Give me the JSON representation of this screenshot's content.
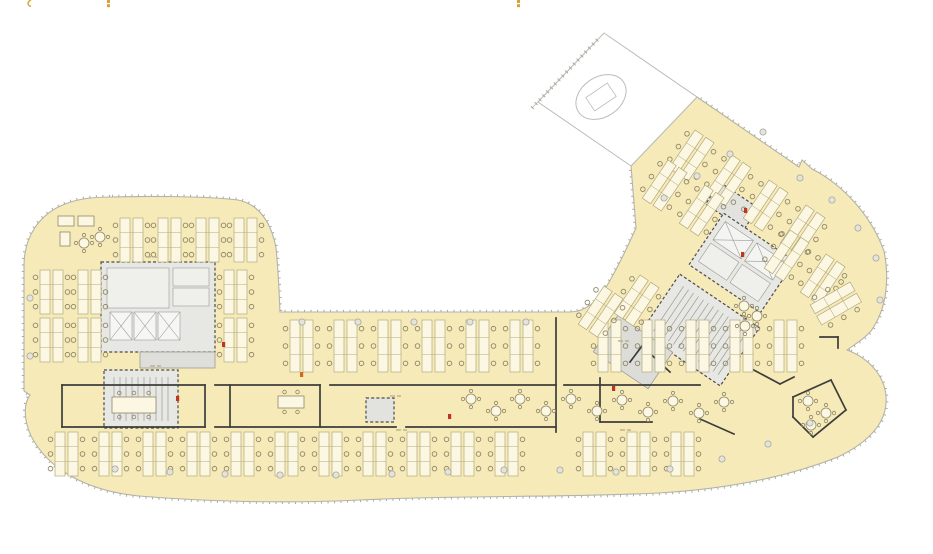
{
  "document": {
    "type": "architectural-floor-plan",
    "visible_text": "",
    "note_labels_illegible": true
  },
  "colors": {
    "background": "#ffffff",
    "floor": "#f6eab9",
    "outline": "#b3b3aa",
    "facade_tick": "#a9a9a0",
    "core_fill": "#e7e7e4",
    "core_inner": "#efefec",
    "core_line": "#9b9b95",
    "core_dash": "#4c4c48",
    "wall": "#3d3d3b",
    "desk_fill": "#fcf7e2",
    "desk_line": "#b4aa7c",
    "chair": "#8f8768",
    "column_fill": "#e4e4dc",
    "column_line": "#a8a89e",
    "atrium_line": "#bcbcb6",
    "micro_label": "#b5ab88",
    "accent_red": "#c3341f",
    "accent_orange": "#d2691e",
    "fragment_orange": "#d9a036"
  },
  "plan": {
    "outline_path": "M 112,197 C 150,196 205,196 238,200 C 258,204 271,221 276,248 C 278,266 279,288 280,312 L 570,312 C 586,312 598,301 608,284 C 620,263 628,246 636,228 L 631,166 L 697,97 L 799,167 L 802,160 L 812,169 C 842,184 871,215 884,251 C 890,281 886,310 871,331 C 862,341 852,346 847,350 C 866,357 884,373 886,396 C 888,421 871,441 838,457 C 787,477 729,489 659,493 C 559,498 459,495 359,500 C 279,504 199,501 139,496 C 89,491 49,471 31,436 C 23,418 24,403 30,395 L 24,391 L 24,266 C 24,237 39,214 65,204 C 80,198 96,197 112,197 Z",
    "atrium": {
      "points": "538,102 604,33 697,97 631,166",
      "tick_line": {
        "x1": 532,
        "y1": 108,
        "x2": 598,
        "y2": 39
      },
      "ellipse": {
        "cx": 601,
        "cy": 97,
        "rx": 27,
        "ry": 20,
        "rot": -34
      },
      "inner_rect": {
        "x": 588,
        "y": 89,
        "w": 26,
        "h": 16
      }
    },
    "cores": [
      {
        "name": "core-left-main",
        "x": 101,
        "y": 262,
        "w": 114,
        "h": 90,
        "dashed": true,
        "cells": [
          {
            "dx": 6,
            "dy": 6,
            "w": 62,
            "h": 40,
            "fill": "#efefec"
          },
          {
            "dx": 9,
            "dy": 50,
            "w": 22,
            "h": 28,
            "fill": "#f6f6f4",
            "cross": true
          },
          {
            "dx": 33,
            "dy": 50,
            "w": 22,
            "h": 28,
            "fill": "#f6f6f4",
            "cross": true
          },
          {
            "dx": 57,
            "dy": 50,
            "w": 22,
            "h": 28,
            "fill": "#f6f6f4",
            "cross": true
          },
          {
            "dx": 72,
            "dy": 6,
            "w": 36,
            "h": 18,
            "fill": "#efefec"
          },
          {
            "dx": 72,
            "dy": 26,
            "w": 36,
            "h": 18,
            "fill": "#efefec"
          }
        ]
      },
      {
        "name": "core-left-connector",
        "x": 140,
        "y": 352,
        "w": 75,
        "h": 16,
        "fill": "#dededb"
      },
      {
        "name": "core-left-stair",
        "x": 104,
        "y": 370,
        "w": 74,
        "h": 58,
        "dashed": true,
        "hatch": {
          "from": 10,
          "to": 64,
          "step": 6,
          "pad": 7
        }
      },
      {
        "name": "core-mid-small",
        "x": 366,
        "y": 398,
        "w": 28,
        "h": 24,
        "fill": "#e2e2df",
        "dashed": true
      },
      {
        "name": "core-wing-upper",
        "x": 709,
        "y": 193,
        "w": 46,
        "h": 26,
        "rot": 34,
        "fill": "#e2e2df",
        "dashed": true
      },
      {
        "name": "core-wing-elevator",
        "x": 699,
        "y": 232,
        "w": 86,
        "h": 62,
        "rot": 34,
        "dashed": true,
        "cells": [
          {
            "dx": 6,
            "dy": 6,
            "w": 34,
            "h": 22,
            "fill": "#f4f4f2",
            "cross": true
          },
          {
            "dx": 44,
            "dy": 6,
            "w": 34,
            "h": 22,
            "fill": "#f4f4f2",
            "cross": true
          },
          {
            "dx": 6,
            "dy": 32,
            "w": 34,
            "h": 22,
            "fill": "#efefec"
          },
          {
            "dx": 44,
            "dy": 32,
            "w": 34,
            "h": 22,
            "fill": "#efefec"
          }
        ]
      },
      {
        "name": "core-wing-stair",
        "x": 652,
        "y": 295,
        "w": 96,
        "h": 70,
        "rot": 34,
        "dashed": true,
        "hatch": {
          "from": 10,
          "to": 88,
          "step": 6,
          "pad": 8
        }
      },
      {
        "name": "core-wing-low",
        "x": 600,
        "y": 330,
        "w": 66,
        "h": 44,
        "rot": 34,
        "fill": "#dcdcd8"
      }
    ],
    "walls": [
      [
        62,
        385,
        205,
        385
      ],
      [
        215,
        385,
        320,
        385
      ],
      [
        330,
        385,
        556,
        385
      ],
      [
        564,
        385,
        700,
        385
      ],
      [
        62,
        427,
        205,
        427
      ],
      [
        215,
        427,
        396,
        427
      ],
      [
        406,
        427,
        556,
        427
      ],
      [
        62,
        385,
        62,
        427
      ],
      [
        205,
        385,
        205,
        427
      ],
      [
        230,
        385,
        230,
        427
      ],
      [
        320,
        385,
        320,
        427
      ],
      [
        556,
        318,
        556,
        432
      ],
      [
        600,
        378,
        600,
        422
      ],
      [
        600,
        422,
        652,
        422
      ],
      [
        630,
        362,
        642,
        346
      ],
      [
        642,
        346,
        670,
        372
      ],
      [
        750,
        368,
        780,
        384
      ],
      [
        780,
        384,
        794,
        377
      ],
      [
        700,
        419,
        734,
        434
      ],
      [
        793,
        397,
        831,
        380
      ],
      [
        831,
        380,
        846,
        410
      ],
      [
        846,
        410,
        813,
        437
      ],
      [
        813,
        437,
        793,
        417
      ],
      [
        793,
        417,
        793,
        397
      ],
      [
        820,
        337,
        838,
        337
      ],
      [
        838,
        337,
        838,
        348
      ]
    ],
    "desk_regions": [
      {
        "name": "desks-left-top",
        "x": 120,
        "y": 218,
        "cols": 4,
        "dx": 38,
        "rows": 1,
        "dy": 0,
        "ch": 44
      },
      {
        "name": "desks-left-west",
        "x": 40,
        "y": 270,
        "cols": 2,
        "dx": 38,
        "rows": 2,
        "dy": 48,
        "ch": 44
      },
      {
        "name": "desks-left-east",
        "x": 224,
        "y": 270,
        "cols": 1,
        "dx": 38,
        "rows": 2,
        "dy": 48,
        "ch": 44
      },
      {
        "name": "desks-mid-top-row",
        "x": 290,
        "y": 320,
        "cols": 12,
        "dx": 44,
        "rows": 1,
        "dy": 0,
        "ch": 52,
        "skip": [
          6
        ]
      },
      {
        "name": "desks-bottom-row",
        "x": 55,
        "y": 432,
        "cols": 15,
        "dx": 44,
        "rows": 1,
        "dy": 0,
        "ch": 44,
        "skip": [
          11
        ]
      }
    ],
    "desk_clusters_rot": [
      {
        "x": 695,
        "y": 130
      },
      {
        "x": 732,
        "y": 155
      },
      {
        "x": 769,
        "y": 180
      },
      {
        "x": 806,
        "y": 205
      },
      {
        "x": 668,
        "y": 160
      },
      {
        "x": 705,
        "y": 185
      },
      {
        "x": 790,
        "y": 230
      },
      {
        "x": 826,
        "y": 254
      },
      {
        "x": 640,
        "y": 275
      },
      {
        "x": 604,
        "y": 286
      },
      {
        "x": 850,
        "y": 282,
        "rot": 60
      }
    ],
    "round_tables": [
      [
        471,
        399
      ],
      [
        496,
        411
      ],
      [
        520,
        399
      ],
      [
        546,
        411
      ],
      [
        571,
        399
      ],
      [
        597,
        411
      ],
      [
        622,
        400
      ],
      [
        648,
        412
      ],
      [
        673,
        401
      ],
      [
        699,
        413
      ],
      [
        724,
        402
      ],
      [
        808,
        401
      ],
      [
        826,
        413
      ],
      [
        811,
        425
      ],
      [
        744,
        306
      ],
      [
        757,
        316
      ],
      [
        745,
        326
      ],
      [
        84,
        243
      ],
      [
        100,
        237
      ]
    ],
    "meeting_tables": [
      {
        "x": 112,
        "y": 397,
        "w": 44,
        "h": 16,
        "chairs": 6
      },
      {
        "x": 278,
        "y": 396,
        "w": 26,
        "h": 12,
        "chairs": 4
      }
    ],
    "furniture_rects": [
      {
        "x": 58,
        "y": 216,
        "w": 16,
        "h": 10
      },
      {
        "x": 78,
        "y": 216,
        "w": 16,
        "h": 10
      },
      {
        "x": 60,
        "y": 232,
        "w": 10,
        "h": 14
      }
    ],
    "columns": [
      [
        115,
        469
      ],
      [
        170,
        472
      ],
      [
        225,
        474
      ],
      [
        280,
        475
      ],
      [
        336,
        475
      ],
      [
        392,
        474
      ],
      [
        448,
        472
      ],
      [
        504,
        470
      ],
      [
        560,
        470
      ],
      [
        616,
        472
      ],
      [
        670,
        469
      ],
      [
        722,
        459
      ],
      [
        768,
        444
      ],
      [
        810,
        423
      ],
      [
        302,
        322
      ],
      [
        358,
        322
      ],
      [
        414,
        322
      ],
      [
        470,
        322
      ],
      [
        526,
        322
      ],
      [
        30,
        298
      ],
      [
        30,
        356
      ],
      [
        664,
        198
      ],
      [
        697,
        176
      ],
      [
        730,
        154
      ],
      [
        763,
        132
      ],
      [
        800,
        178
      ],
      [
        832,
        200
      ],
      [
        858,
        228
      ],
      [
        876,
        258
      ],
      [
        880,
        300
      ]
    ],
    "micro_labels": [
      [
        146,
        257
      ],
      [
        150,
        366
      ],
      [
        390,
        396
      ],
      [
        396,
        430
      ],
      [
        618,
        341
      ],
      [
        620,
        430
      ]
    ],
    "accents": [
      [
        300,
        372,
        "#d2691e"
      ],
      [
        741,
        252,
        "#c3341f"
      ],
      [
        612,
        386,
        "#c3341f"
      ],
      [
        176,
        396,
        "#c3341f"
      ],
      [
        222,
        342,
        "#c3341f"
      ],
      [
        448,
        414,
        "#c3341f"
      ],
      [
        744,
        208,
        "#c3341f"
      ]
    ],
    "edge_fragments": [
      {
        "x": 27,
        "type": "curve"
      },
      {
        "x": 107,
        "type": "double"
      },
      {
        "x": 517,
        "type": "double"
      }
    ]
  }
}
